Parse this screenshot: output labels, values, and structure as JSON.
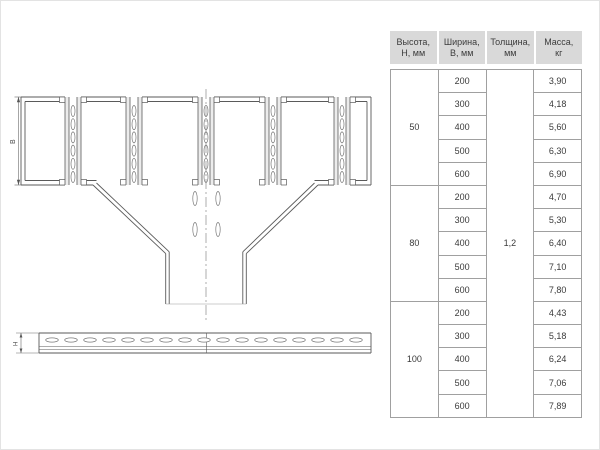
{
  "drawing": {
    "top_view": {
      "width_dim_label": "В"
    },
    "side_view": {
      "height_dim_label": "Н"
    }
  },
  "table": {
    "headers": [
      {
        "line1": "Высота,",
        "line2": "Н, мм"
      },
      {
        "line1": "Ширина,",
        "line2": "В, мм"
      },
      {
        "line1": "Толщина,",
        "line2": "мм"
      },
      {
        "line1": "Масса,",
        "line2": "кг"
      }
    ],
    "thickness": "1,2",
    "groups": [
      {
        "height": "50",
        "rows": [
          {
            "width": "200",
            "mass": "3,90"
          },
          {
            "width": "300",
            "mass": "4,18"
          },
          {
            "width": "400",
            "mass": "5,60"
          },
          {
            "width": "500",
            "mass": "6,30"
          },
          {
            "width": "600",
            "mass": "6,90"
          }
        ]
      },
      {
        "height": "80",
        "rows": [
          {
            "width": "200",
            "mass": "4,70"
          },
          {
            "width": "300",
            "mass": "5,30"
          },
          {
            "width": "400",
            "mass": "6,40"
          },
          {
            "width": "500",
            "mass": "7,10"
          },
          {
            "width": "600",
            "mass": "7,80"
          }
        ]
      },
      {
        "height": "100",
        "rows": [
          {
            "width": "200",
            "mass": "4,43"
          },
          {
            "width": "300",
            "mass": "5,18"
          },
          {
            "width": "400",
            "mass": "6,24"
          },
          {
            "width": "500",
            "mass": "7,06"
          },
          {
            "width": "600",
            "mass": "7,89"
          }
        ]
      }
    ]
  },
  "colors": {
    "header_bg": "#d9d9d9",
    "table_border": "#a0a0a0",
    "line": "#555555",
    "text": "#3a3a3a"
  }
}
